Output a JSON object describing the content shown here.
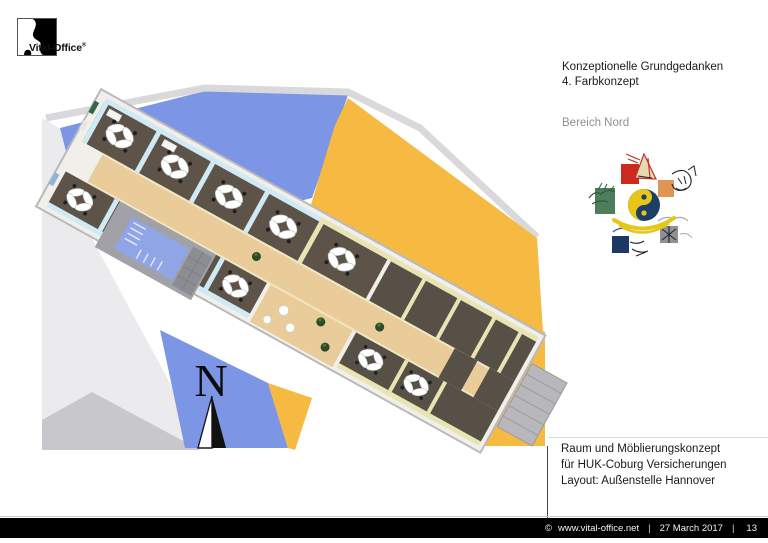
{
  "logo": {
    "brand": "Vital-Office",
    "registered_mark": "®"
  },
  "header": {
    "title_line1": "Konzeptionelle Grundgedanken",
    "title_line2": "4. Farbkonzept",
    "section_label": "Bereich Nord"
  },
  "five_elements": {
    "center_symbol": "yin-yang",
    "elements": [
      "fire",
      "earth",
      "metal",
      "water",
      "wood"
    ],
    "colors": {
      "fire": "#cc2a1e",
      "earth": "#e09552",
      "metal": "#909095",
      "water": "#1d3766",
      "wood": "#4e7d5c",
      "yin_yang_blue": "#1b3f66",
      "yin_yang_yellow": "#e6c619"
    }
  },
  "floor_plan": {
    "compass_letter": "N",
    "palette": {
      "site_blue": "#7c95e4",
      "site_orange": "#f6b942",
      "site_gray": "#d9d9dc",
      "room_floor_dark": "#5d5349",
      "wall_light_blue": "#cfe9f5",
      "wall_cream": "#e9e4b4",
      "corridor_wood": "#e9cc9a",
      "stairwell_blue": "#8fa5e6"
    }
  },
  "project_info": {
    "line1": "Raum und Möblierungskonzept",
    "line2": "für HUK-Coburg Versicherungen",
    "line3": "Layout: Außenstelle Hannover"
  },
  "footer": {
    "copyright_symbol": "©",
    "website": "www.vital-office.net",
    "separator": "|",
    "date": "27 March 2017",
    "page_number": "13"
  }
}
